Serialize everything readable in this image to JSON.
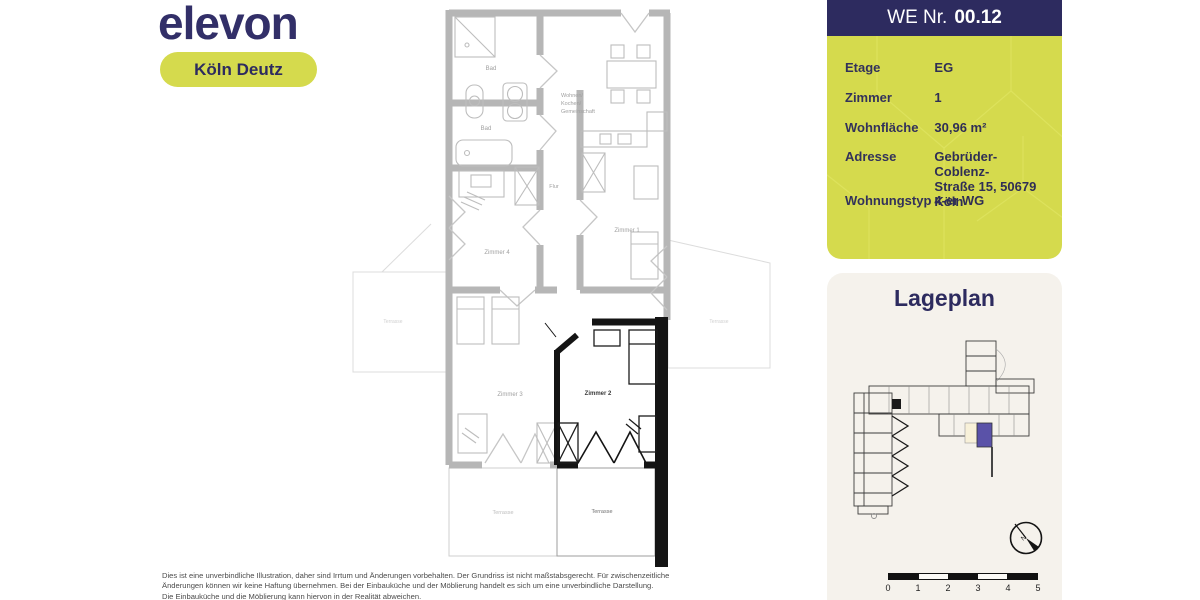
{
  "brand": {
    "logo": "elevon",
    "location_pill": "Köln Deutz"
  },
  "unit_panel": {
    "title_prefix": "WE Nr.",
    "title_number": "00.12",
    "rows": [
      {
        "label": "Etage",
        "value": "EG"
      },
      {
        "label": "Zimmer",
        "value": "1"
      },
      {
        "label": "Wohnfläche",
        "value": "30,96 m²"
      },
      {
        "label": "Adresse",
        "value": "Gebrüder-Coblenz-",
        "value2": "Straße 15, 50679 Köln"
      },
      {
        "label": "Wohnungstyp",
        "value": "4-er WG"
      }
    ]
  },
  "floorplan": {
    "labels": {
      "bad_top": "Bad",
      "bad_bottom": "Bad",
      "living1": "Wohnen/",
      "living2": "Kochen/",
      "living3": "Gemeinschaft",
      "flur": "Flur",
      "zimmer1": "Zimmer 1",
      "zimmer2": "Zimmer 2",
      "zimmer3": "Zimmer 3",
      "zimmer4": "Zimmer 4",
      "terrace_left": "Terrasse",
      "terrace_right": "Terrasse",
      "terrace_bottom_left": "Terrasse",
      "terrace_bottom_right": "Terrasse"
    }
  },
  "lageplan": {
    "title": "Lageplan",
    "compass": "N",
    "scale_ticks": [
      "0",
      "1",
      "2",
      "3",
      "4",
      "5"
    ]
  },
  "disclaimer": {
    "line1": "Dies ist eine unverbindliche Illustration, daher sind Irrtum und Änderungen vorbehalten. Der Grundriss ist nicht maßstabsgerecht. Für zwischenzeitliche",
    "line2": "Änderungen können wir keine Haftung übernehmen. Bei der Einbauküche und der Möblierung handelt es sich um eine unverbindliche Darstellung.",
    "line3": "Die Einbauküche und die Möblierung kann hiervon in der Realität abweichen."
  },
  "colors": {
    "navy": "#2d2b5f",
    "lime": "#d5da4d",
    "unit_highlight": "#5a52a8",
    "card_bg": "#f5f2ec"
  }
}
